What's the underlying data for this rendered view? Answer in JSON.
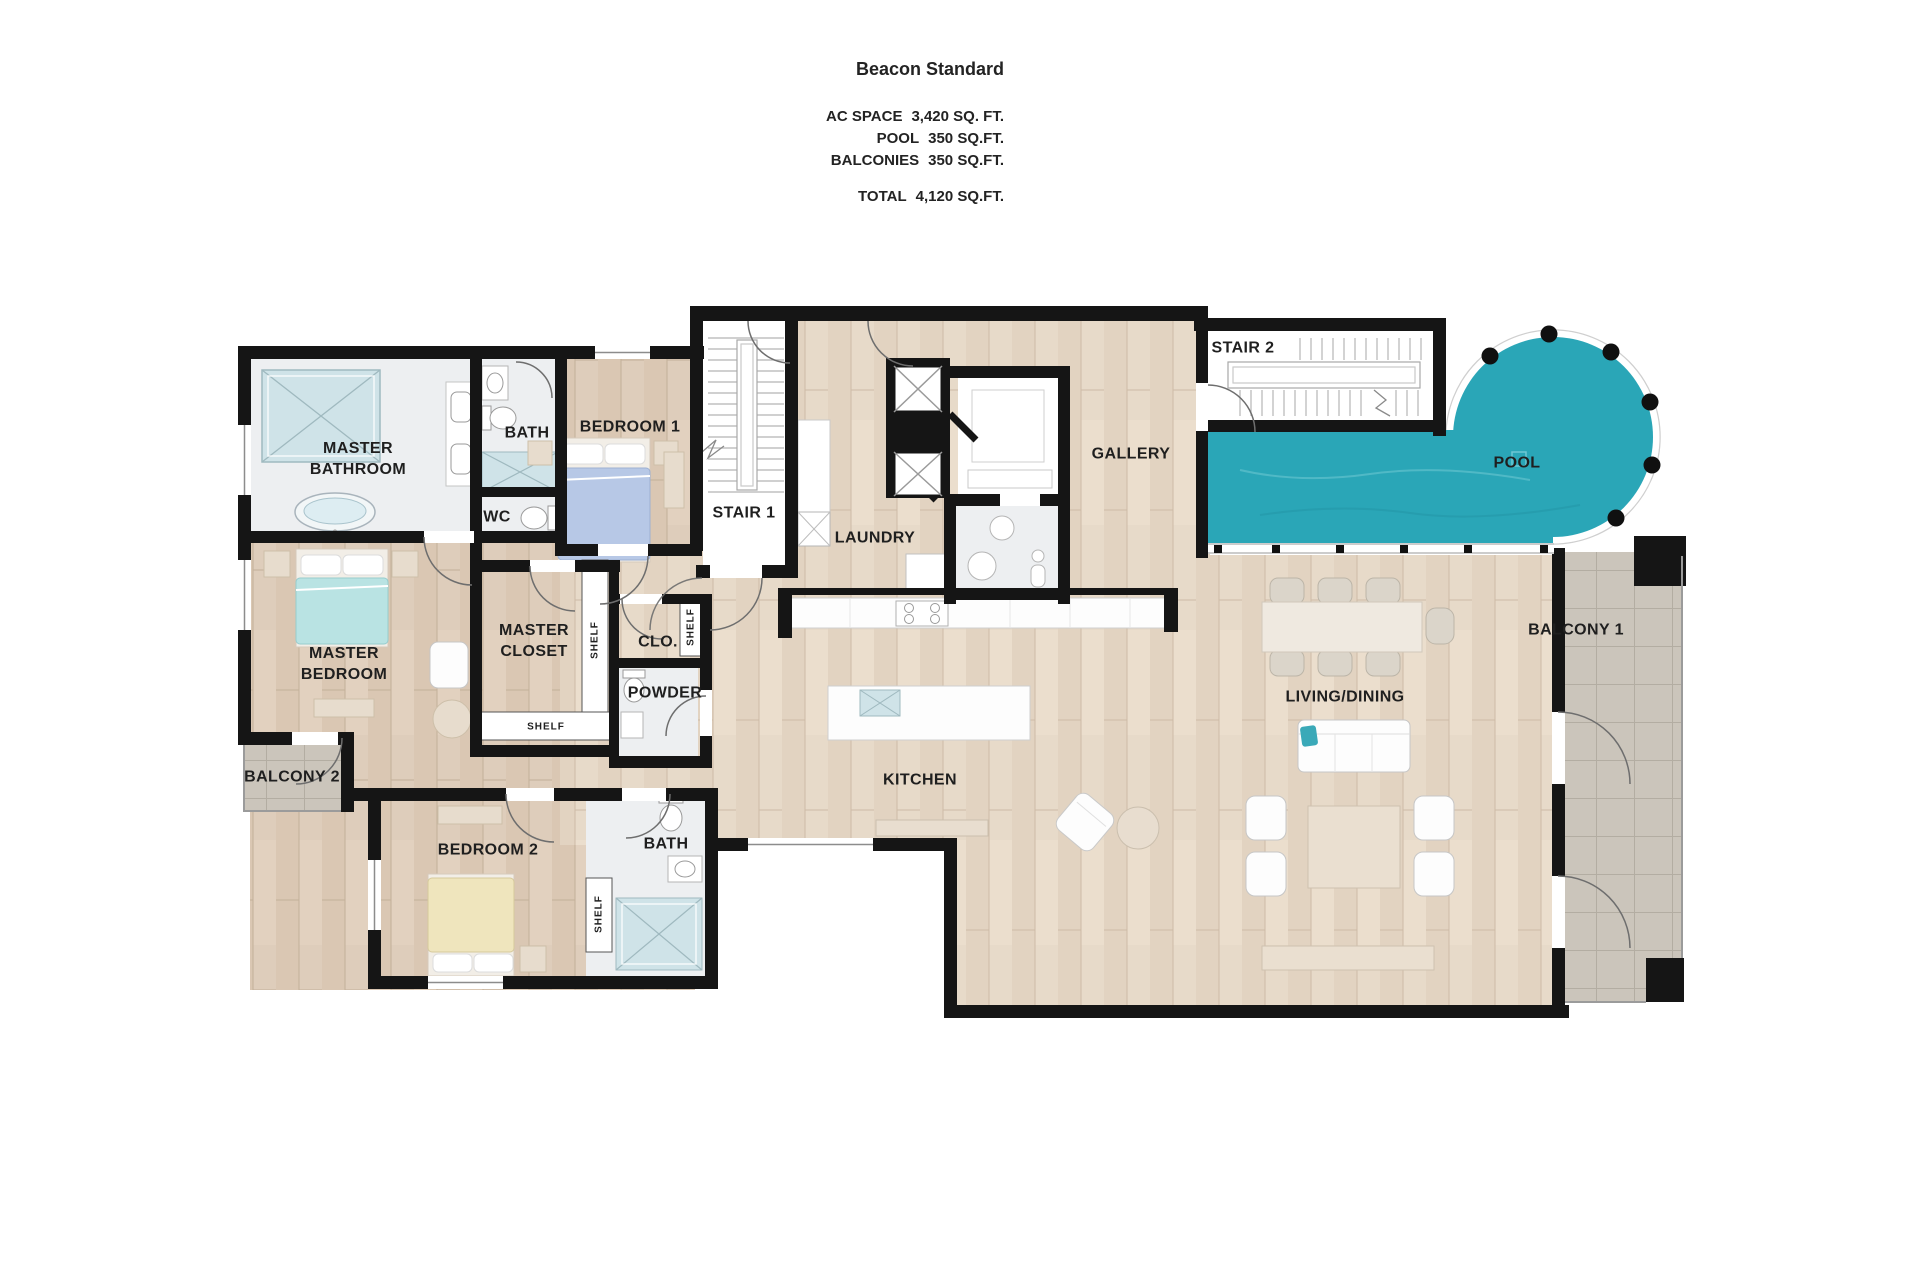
{
  "title_block": {
    "title": "Beacon Standard",
    "stats": [
      {
        "label": "AC SPACE",
        "value": "3,420 SQ. FT."
      },
      {
        "label": "POOL",
        "value": "350 SQ.FT."
      },
      {
        "label": "BALCONIES",
        "value": "350 SQ.FT."
      }
    ],
    "total": {
      "label": "TOTAL",
      "value": "4,120 SQ.FT."
    }
  },
  "rooms": {
    "master_bathroom": "MASTER\nBATHROOM",
    "bath_1": "BATH",
    "wc": "WC",
    "bedroom_1": "BEDROOM 1",
    "stair_1": "STAIR 1",
    "laundry": "LAUNDRY",
    "gallery": "GALLERY",
    "stair_2": "STAIR 2",
    "pool": "POOL",
    "master_bedroom": "MASTER\nBEDROOM",
    "master_closet": "MASTER\nCLOSET",
    "clo": "CLO.",
    "powder": "POWDER",
    "balcony_2": "BALCONY 2",
    "bedroom_2": "BEDROOM 2",
    "bath_2": "BATH",
    "kitchen": "KITCHEN",
    "living_dining": "LIVING/DINING",
    "balcony_1": "BALCONY 1",
    "shelf_master_closet_side": "SHELF",
    "shelf_master_closet_bottom": "SHELF",
    "shelf_clo": "SHELF",
    "shelf_bath_2": "SHELF"
  },
  "colors": {
    "wall": "#151515",
    "wood": "#decdbb",
    "wood_light": "#e7dac9",
    "marble": "#edeff1",
    "tile": "#cfe3e8",
    "pool": "#2aa6b7",
    "balcony": "#cbc5bb",
    "label": "#1f1f1f",
    "accent_teal": "#3aa9b8"
  }
}
